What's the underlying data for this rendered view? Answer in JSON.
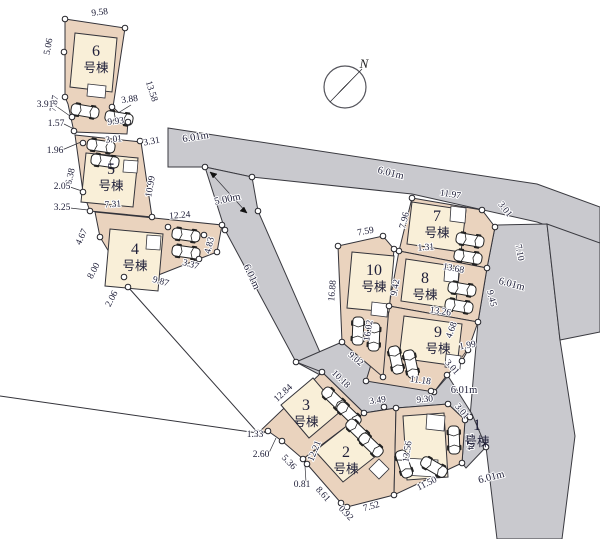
{
  "plan": {
    "title": "housing site plan",
    "compass": {
      "north_label": "N"
    },
    "colors": {
      "road": "#c9c9ce",
      "lot": "#ead3be",
      "house": "#f9efd8",
      "ink": "#20203a"
    },
    "buildings": [
      {
        "number": "6",
        "suffix": "号棟",
        "x": 96,
        "y": 56
      },
      {
        "number": "5",
        "suffix": "号棟",
        "x": 111,
        "y": 174
      },
      {
        "number": "4",
        "suffix": "号棟",
        "x": 135,
        "y": 254
      },
      {
        "number": "3",
        "suffix": "号棟",
        "x": 306,
        "y": 410
      },
      {
        "number": "2",
        "suffix": "号棟",
        "x": 346,
        "y": 457
      },
      {
        "number": "1",
        "suffix": "号棟",
        "x": 477,
        "y": 430
      },
      {
        "number": "7",
        "suffix": "号棟",
        "x": 437,
        "y": 221
      },
      {
        "number": "8",
        "suffix": "号棟",
        "x": 425,
        "y": 283
      },
      {
        "number": "9",
        "suffix": "号棟",
        "x": 438,
        "y": 337
      },
      {
        "number": "10",
        "suffix": "号棟",
        "x": 374,
        "y": 275
      }
    ],
    "dimension_labels": [
      {
        "t": "9.58",
        "x": 100,
        "y": 15,
        "r": -7
      },
      {
        "t": "5.06",
        "x": 51,
        "y": 47,
        "r": -80
      },
      {
        "t": "7.87",
        "x": 57,
        "y": 104,
        "r": -80
      },
      {
        "t": "13.58",
        "x": 149,
        "y": 92,
        "r": 72
      },
      {
        "t": "3.88",
        "x": 130,
        "y": 102,
        "r": -8
      },
      {
        "t": "3.91",
        "x": 45,
        "y": 107,
        "r": 0
      },
      {
        "t": "1.57",
        "x": 56,
        "y": 126,
        "r": 0
      },
      {
        "t": "9.93",
        "x": 116,
        "y": 124,
        "r": -6
      },
      {
        "t": "3.01",
        "x": 114,
        "y": 142,
        "r": -6
      },
      {
        "t": "3.31",
        "x": 152,
        "y": 144,
        "r": -10
      },
      {
        "t": "6.01m",
        "x": 196,
        "y": 140,
        "r": -9,
        "s": 10.5
      },
      {
        "t": "1.96",
        "x": 55,
        "y": 153,
        "r": 0
      },
      {
        "t": "6.38",
        "x": 73,
        "y": 177,
        "r": -78
      },
      {
        "t": "10.99",
        "x": 153,
        "y": 187,
        "r": -80
      },
      {
        "t": "2.05",
        "x": 62,
        "y": 189,
        "r": 0
      },
      {
        "t": "3.25",
        "x": 62,
        "y": 210,
        "r": 0
      },
      {
        "t": "7.31",
        "x": 113,
        "y": 207,
        "r": -4
      },
      {
        "t": "12.24",
        "x": 180,
        "y": 218,
        "r": -5
      },
      {
        "t": "5.00m",
        "x": 228,
        "y": 202,
        "r": -12,
        "s": 10.5
      },
      {
        "t": "4.67",
        "x": 84,
        "y": 238,
        "r": -65
      },
      {
        "t": "8.00",
        "x": 96,
        "y": 272,
        "r": -62
      },
      {
        "t": "2.06",
        "x": 114,
        "y": 300,
        "r": -62
      },
      {
        "t": "9.87",
        "x": 160,
        "y": 284,
        "r": 16
      },
      {
        "t": "3.37",
        "x": 190,
        "y": 267,
        "r": 16
      },
      {
        "t": "4.83",
        "x": 212,
        "y": 246,
        "r": -76
      },
      {
        "t": "6.01m",
        "x": 249,
        "y": 278,
        "r": 65,
        "s": 10.5
      },
      {
        "t": "6.01m",
        "x": 390,
        "y": 176,
        "r": 14,
        "s": 10.5
      },
      {
        "t": "7.59",
        "x": 366,
        "y": 234,
        "r": -10
      },
      {
        "t": "7.96",
        "x": 407,
        "y": 221,
        "r": -76
      },
      {
        "t": "11.97",
        "x": 450,
        "y": 197,
        "r": 9
      },
      {
        "t": "3.01",
        "x": 503,
        "y": 211,
        "r": 52
      },
      {
        "t": "7.10",
        "x": 517,
        "y": 253,
        "r": 80
      },
      {
        "t": "1.31",
        "x": 426,
        "y": 250,
        "r": -4
      },
      {
        "t": "13.68",
        "x": 453,
        "y": 271,
        "r": 11
      },
      {
        "t": "9.42",
        "x": 398,
        "y": 288,
        "r": -80
      },
      {
        "t": "9.45",
        "x": 489,
        "y": 299,
        "r": 76
      },
      {
        "t": "6.01m",
        "x": 511,
        "y": 287,
        "r": 15,
        "s": 10.5
      },
      {
        "t": "13.26",
        "x": 440,
        "y": 314,
        "r": 9
      },
      {
        "t": "16.88",
        "x": 335,
        "y": 291,
        "r": -85
      },
      {
        "t": "16.02",
        "x": 371,
        "y": 331,
        "r": -81
      },
      {
        "t": "4.68",
        "x": 454,
        "y": 331,
        "r": -70
      },
      {
        "t": "1.99",
        "x": 468,
        "y": 348,
        "r": -10
      },
      {
        "t": "3.01",
        "x": 450,
        "y": 369,
        "r": 48
      },
      {
        "t": "11.18",
        "x": 420,
        "y": 383,
        "r": 8
      },
      {
        "t": "6.01m",
        "x": 464,
        "y": 393,
        "r": 0,
        "s": 10.5
      },
      {
        "t": "9.02",
        "x": 354,
        "y": 361,
        "r": 40
      },
      {
        "t": "10.18",
        "x": 339,
        "y": 381,
        "r": 44
      },
      {
        "t": "3.49",
        "x": 378,
        "y": 403,
        "r": -8
      },
      {
        "t": "9.30",
        "x": 425,
        "y": 402,
        "r": -5
      },
      {
        "t": "3.01",
        "x": 460,
        "y": 413,
        "r": 50
      },
      {
        "t": "7.24",
        "x": 467,
        "y": 442,
        "r": 86
      },
      {
        "t": "12.84",
        "x": 285,
        "y": 395,
        "r": -43
      },
      {
        "t": "1.33",
        "x": 255,
        "y": 437,
        "r": 0
      },
      {
        "t": "2.60",
        "x": 261,
        "y": 457,
        "r": 0
      },
      {
        "t": "5.36",
        "x": 287,
        "y": 464,
        "r": 46
      },
      {
        "t": "12.21",
        "x": 317,
        "y": 452,
        "r": -68
      },
      {
        "t": "13.56",
        "x": 410,
        "y": 452,
        "r": -82
      },
      {
        "t": "0.81",
        "x": 302,
        "y": 487,
        "r": 0
      },
      {
        "t": "8.61",
        "x": 321,
        "y": 496,
        "r": 48
      },
      {
        "t": "0.92",
        "x": 344,
        "y": 515,
        "r": 46
      },
      {
        "t": "7.52",
        "x": 372,
        "y": 509,
        "r": -16
      },
      {
        "t": "11.50",
        "x": 428,
        "y": 486,
        "r": -26
      },
      {
        "t": "6.01m",
        "x": 492,
        "y": 480,
        "r": -14,
        "s": 10.5
      }
    ]
  }
}
